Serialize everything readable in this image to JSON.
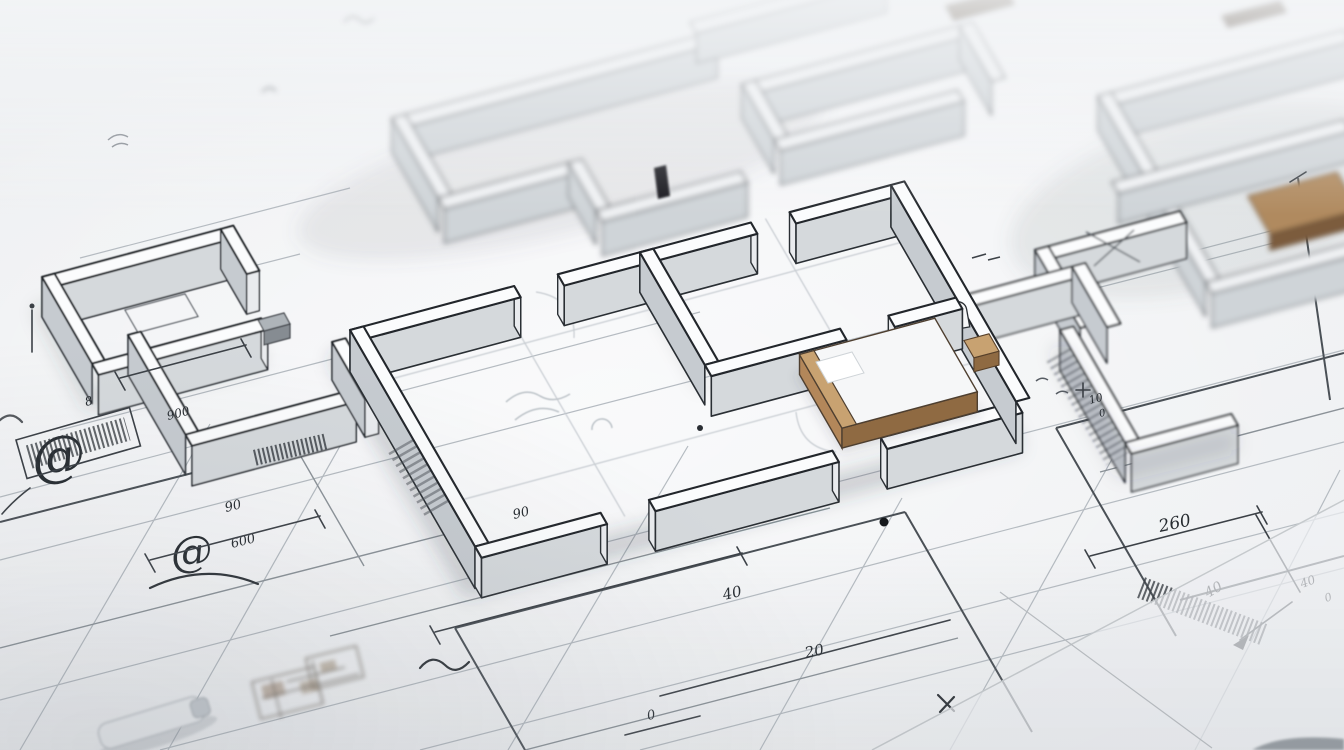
{
  "description": "Close-up photograph of a white 3D architectural scale model of a floor plan standing on a hand-annotated blueprint drawing; the upper portion is softly out of focus, tan wooden furniture blocks sit inside the rooms, and handwritten dimension figures, @-like scribbles and hatched illegible labels cover the paper around the model.",
  "scene": {
    "subject": "3d-architectural-floor-plan-model",
    "surface": "blueprint-paper-with-hand-annotations",
    "focus": "center-sharp-edges-blurred",
    "furniture": [
      "wooden-bed-block",
      "wooden-table-top",
      "dark-wood-planks",
      "white-desk-block"
    ]
  },
  "palette": {
    "paper": "#f1f3f5",
    "paper_shade": "#e4e7ea",
    "ink_dark": "#23282d",
    "ink_mid": "#596068",
    "ink_faint": "#b4bac0",
    "wall_top": "#fbfcfd",
    "wall_side": "#d5d9dc",
    "wall_side_dark": "#c6cbd0",
    "wood_light": "#c8a271",
    "wood_mid": "#b3875a",
    "wood_dark": "#7c5c3d",
    "wood_plank": "#53422f",
    "shadow": "rgba(60,66,76,0.2)"
  },
  "annotations": {
    "at_large": "@",
    "at_small": "@",
    "dim_8": "8",
    "dim_900": "900",
    "dim_90": "90",
    "dim_90_b": "90",
    "dim_600": "600",
    "dim_40_center": "40",
    "dim_20": "20",
    "dim_0_center": "0",
    "dim_260": "260",
    "dim_40_right": "40",
    "dim_40_far_right": "40",
    "dim_0_right": "0",
    "dim_10": "10",
    "dim_0_plus": "0"
  }
}
